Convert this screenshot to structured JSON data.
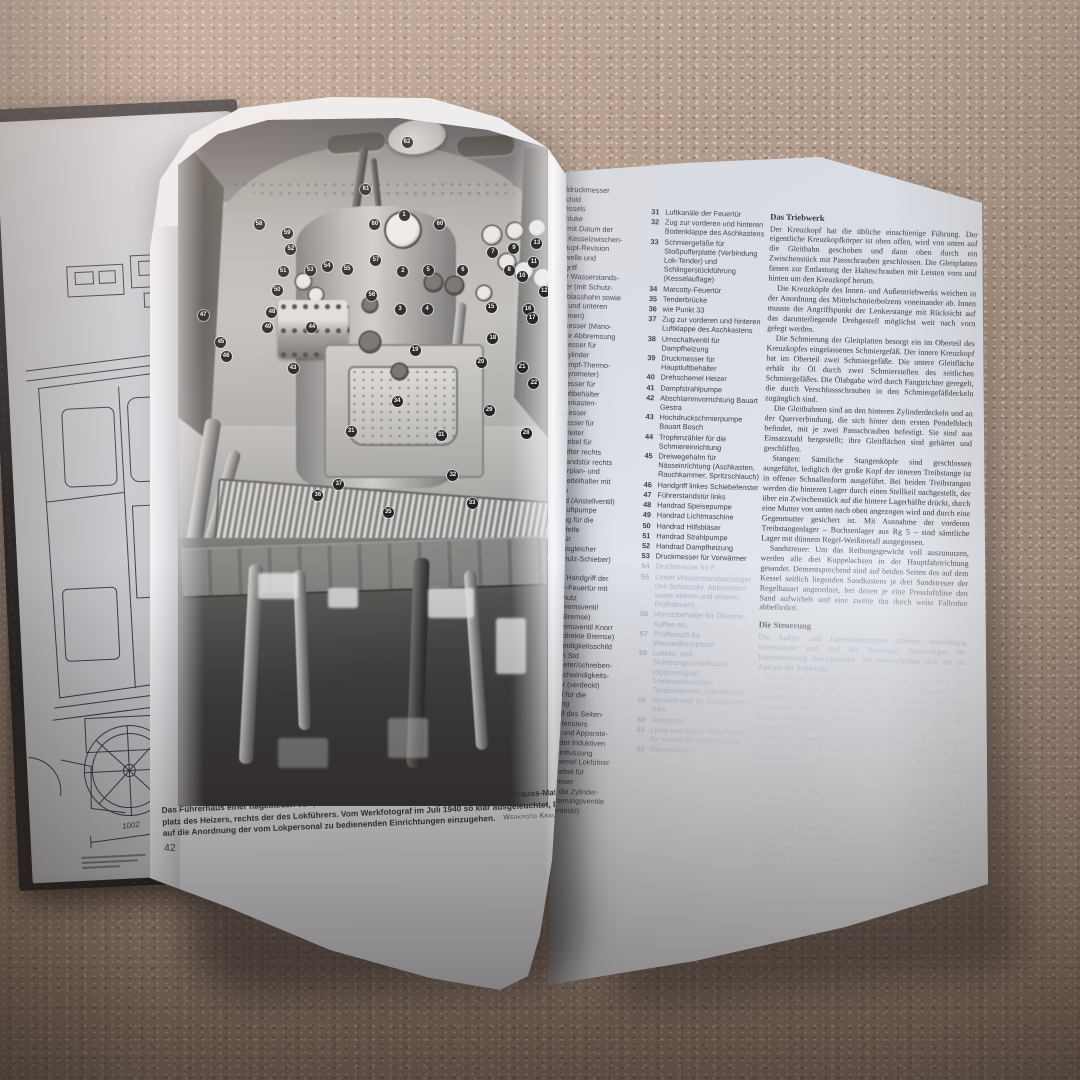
{
  "colors": {
    "carpet": "#ac9585",
    "paper": "#e3e6ec",
    "cover": "#1b1c20",
    "badge_bg": "#17171b",
    "badge_text": "#f4f4f2"
  },
  "drawing_page": {
    "dimension_label": "1002"
  },
  "photo_page": {
    "page_number": "42",
    "caption": {
      "line1": "Das Führerhaus einer nagelneuen 03¹⁰, hier der 03 1073, kurz vor ihrer Fertigstellung bei Krauss-Maffei in München. Links der",
      "line2": "platz des Heizers, rechts der des Lokführers. Vom Werkfotograf im Juli 1940 so klar ausgeleuchtet, lädt die Aufnahme",
      "line3": "auf die Anordnung der vom Lokpersonal zu bedienenden Einrichtungen einzugehen.",
      "credit": "Werkfoto Krauss-Maffei"
    },
    "badges": [
      {
        "n": "62",
        "x": 61.9,
        "y": 3.5
      },
      {
        "n": "61",
        "x": 50.8,
        "y": 10.4
      },
      {
        "n": "1",
        "x": 61.1,
        "y": 14.2
      },
      {
        "n": "60",
        "x": 53.2,
        "y": 15.5
      },
      {
        "n": "60",
        "x": 70.8,
        "y": 15.5
      },
      {
        "n": "58",
        "x": 21.9,
        "y": 15.5
      },
      {
        "n": "59",
        "x": 29.5,
        "y": 16.8
      },
      {
        "n": "52",
        "x": 30.5,
        "y": 19.1
      },
      {
        "n": "57",
        "x": 53.5,
        "y": 20.7
      },
      {
        "n": "2",
        "x": 60.8,
        "y": 22.3
      },
      {
        "n": "5",
        "x": 67.6,
        "y": 22.2
      },
      {
        "n": "6",
        "x": 77.0,
        "y": 22.2
      },
      {
        "n": "7",
        "x": 85.1,
        "y": 19.6
      },
      {
        "n": "9",
        "x": 90.8,
        "y": 19.0
      },
      {
        "n": "13",
        "x": 97.0,
        "y": 18.3
      },
      {
        "n": "11",
        "x": 96.2,
        "y": 21.0
      },
      {
        "n": "8",
        "x": 89.5,
        "y": 22.2
      },
      {
        "n": "10",
        "x": 93.0,
        "y": 23.0
      },
      {
        "n": "12",
        "x": 99.0,
        "y": 25.2
      },
      {
        "n": "51",
        "x": 28.4,
        "y": 22.3
      },
      {
        "n": "53",
        "x": 35.7,
        "y": 22.2
      },
      {
        "n": "54",
        "x": 40.3,
        "y": 21.6
      },
      {
        "n": "55",
        "x": 45.7,
        "y": 22.0
      },
      {
        "n": "50",
        "x": 26.8,
        "y": 25.1
      },
      {
        "n": "56",
        "x": 52.4,
        "y": 25.8
      },
      {
        "n": "3",
        "x": 60.0,
        "y": 27.8
      },
      {
        "n": "4",
        "x": 67.3,
        "y": 27.8
      },
      {
        "n": "48",
        "x": 25.4,
        "y": 28.3
      },
      {
        "n": "49",
        "x": 24.3,
        "y": 30.4
      },
      {
        "n": "44",
        "x": 36.2,
        "y": 30.4
      },
      {
        "n": "47",
        "x": 6.8,
        "y": 28.7
      },
      {
        "n": "45",
        "x": 11.6,
        "y": 32.6
      },
      {
        "n": "46",
        "x": 13.0,
        "y": 34.6
      },
      {
        "n": "15",
        "x": 84.6,
        "y": 27.5
      },
      {
        "n": "16",
        "x": 94.6,
        "y": 27.8
      },
      {
        "n": "17",
        "x": 95.7,
        "y": 29.1
      },
      {
        "n": "18",
        "x": 85.1,
        "y": 32.0
      },
      {
        "n": "19",
        "x": 64.1,
        "y": 33.8
      },
      {
        "n": "20",
        "x": 81.9,
        "y": 35.5
      },
      {
        "n": "21",
        "x": 93.0,
        "y": 36.2
      },
      {
        "n": "22",
        "x": 96.2,
        "y": 38.6
      },
      {
        "n": "43",
        "x": 31.1,
        "y": 36.4
      },
      {
        "n": "29",
        "x": 84.1,
        "y": 42.5
      },
      {
        "n": "28",
        "x": 94.1,
        "y": 45.9
      },
      {
        "n": "34",
        "x": 59.2,
        "y": 41.2
      },
      {
        "n": "31",
        "x": 46.8,
        "y": 45.5
      },
      {
        "n": "31",
        "x": 71.1,
        "y": 46.1
      },
      {
        "n": "32",
        "x": 74.3,
        "y": 51.9
      },
      {
        "n": "37",
        "x": 43.5,
        "y": 53.3
      },
      {
        "n": "36",
        "x": 37.8,
        "y": 54.9
      },
      {
        "n": "33",
        "x": 79.5,
        "y": 56.0
      },
      {
        "n": "35",
        "x": 56.8,
        "y": 57.4
      }
    ]
  },
  "right_page": {
    "page_number": "43",
    "legend_column1_fragments": [
      "sseldruckmesser",
      "rikschild",
      "s Kessels",
      "aschluke",
      "hild mit Datum der",
      "rten Kesselzwischen-",
      "d Haupt-Revision",
      "glerwelle und",
      "glergriff",
      "chter Wasserstands-",
      "zeiger (mit Schutz-",
      "rb, Ablasshahn sowie",
      "eren und unteren",
      "üfhähnen)",
      "uckmesser (Mano-",
      "ter) für Abbremsung",
      "uckmesser für",
      "emszylinder",
      "eißdampf-Thermo-",
      "ter (Pyrometer)",
      "uckmesser für",
      "auptluftbehälter",
      "chieberkasten-",
      "ruckmesser",
      "uckmesser für",
      "uptluftleiter",
      "rstellhebel für",
      "ckenlüfter rechts",
      "hrerstandstür rechts",
      "chtfahrplan- und",
      "remszettelhalter mit",
      "euchte",
      "andrad (Anstellventil)",
      "r die Luftpumpe",
      "ebelzug für die",
      "ampfpfeife",
      "child für",
      "ruckausgleicher",
      "arl-Schulz-Schieber)",
      "nlage",
      "echter Handgriff der",
      "arcotty-Feuertür mit",
      "andschutz",
      "usatzbremsventil",
      "irekte Bremse)",
      "hrerbremsventil Knorr",
      "r. 8 (indirekte Bremse)",
      "eschwindigkeitsschild",
      "150 km Std",
      "achometer/schreiben-",
      "er Geschwindigkeits-",
      "messer (verdeckt)",
      "andrad für die",
      "teuerung",
      "andgriff des Seiten-",
      "chiebefensters",
      "asten- und Apparate-",
      "asten der Induktiven",
      "ugbeeinflussung",
      "rehschemel Lokführer",
      "nstellhebel für",
      "andstreuer",
      "ug für die Zylinder-",
      "ntwässerungsventile",
      "alb verdeckt)"
    ],
    "legend": [
      {
        "n": "31",
        "text": "Luftkanäle der Feuertür"
      },
      {
        "n": "32",
        "text": "Zug zur vorderen und hinteren Bodenklappe des Aschkastens"
      },
      {
        "n": "33",
        "text": "Schmiergefäße für Stoßpufferplatte (Verbindung Lok-Tender) und Schlingerstückführung (Kesselauflage)"
      },
      {
        "n": "34",
        "text": "Marcotty-Feuertür"
      },
      {
        "n": "35",
        "text": "Tenderbrücke"
      },
      {
        "n": "36",
        "text": "wie Punkt 33"
      },
      {
        "n": "37",
        "text": "Zug zur vorderen und hinteren Luftklappe des Aschkastens"
      },
      {
        "n": "38",
        "text": "Umschaltventil für Dampfheizung"
      },
      {
        "n": "39",
        "text": "Druckmesser für Hauptluftbehälter"
      },
      {
        "n": "40",
        "text": "Drehschemel Heizer"
      },
      {
        "n": "41",
        "text": "Dampfstrahlpumpe"
      },
      {
        "n": "42",
        "text": "Abschlammvorrichtung Bauart Gestra"
      },
      {
        "n": "43",
        "text": "Hochdruckschmierpumpe Bauart Bosch"
      },
      {
        "n": "44",
        "text": "Tropfenzähler für die Schmiereinrichtung"
      },
      {
        "n": "45",
        "text": "Dreiwegehahn für Nässeinrichtung (Aschkasten, Rauchkammer, Spritzschlauch)"
      },
      {
        "n": "46",
        "text": "Handgriff linkes Schiebefenster"
      },
      {
        "n": "47",
        "text": "Führerstandstür links"
      },
      {
        "n": "48",
        "text": "Handrad Speisepumpe"
      },
      {
        "n": "49",
        "text": "Handrad Lichtmaschine"
      },
      {
        "n": "50",
        "text": "Handrad Hilfsbläser"
      },
      {
        "n": "51",
        "text": "Handrad Strahlpumpe"
      },
      {
        "n": "52",
        "text": "Handrad Dampfheizung"
      },
      {
        "n": "53",
        "text": "Druckmesser für Vorwärmer"
      },
      {
        "n": "54",
        "text": "Druckmesser für F…",
        "faint": true
      },
      {
        "n": "55",
        "text": "Linker Wasserstandsanzeiger (mit Schutzrohr, Ablasshahn sowie oberen und unteren Prüfhähnen)",
        "faint": true
      },
      {
        "n": "56",
        "text": "Vorratsbehälter für Ölkanne, Kaffee etc.",
        "faint": true
      },
      {
        "n": "57",
        "text": "Prüfflansch für Wasserdruckprobe",
        "faint": true
      },
      {
        "n": "58",
        "text": "Lokkist- und Sicherungsschaffkasten (Spitzensignal, Triebwerkleuchten, Tenderlaternen, Führerhaus)",
        "faint": true
      },
      {
        "n": "59",
        "text": "Verstellhebel für Deckenlüfter links",
        "faint": true
      },
      {
        "n": "60",
        "text": "Steckdose",
        "faint": true
      },
      {
        "n": "61",
        "text": "Linke und rechte Rüttelhebel für Kessel-Sicherheitsventil",
        "faint": true
      },
      {
        "n": "62",
        "text": "Deckenlampe",
        "faint": true
      }
    ],
    "sections": [
      {
        "heading": "Das Triebwerk",
        "paragraphs": [
          {
            "fade": 0,
            "text": "Der Kreuzkopf hat die übliche einschienige Führung. Der eigentliche Kreuzkopfkörper ist oben offen, wird von unten auf die Gleitbahn geschoben und dann oben durch ein Zwischenstück mit Passschrauben geschlossen. Die Gleitplatten fassen zur Entlastung der Halteschrauben mit Leisten vorn und hinten um den Kreuzkopf herum."
          },
          {
            "fade": 0,
            "text": "Die Kreuzköpfe des Innen- und Außentriebwerks weichen in der Anordnung des Mittelschmierbolzens voneinander ab. Innen musste der Angriffspunkt der Lenkerstange mit Rücksicht auf das darunterliegende Drehgestell möglichst weit nach vorn gelegt werden."
          },
          {
            "fade": 0,
            "text": "Die Schmierung der Gleitplatten besorgt ein im Oberteil des Kreuzkopfes eingelassenes Schmiergefäß. Der innere Kreuzkopf hat im Oberteil zwei Schmiergefäße. Die untere Gleitfläche erhält ihr Öl durch zwei Schmierstellen des seitlichen Schmiergefäßes. Die Ölabgabe wird durch Fangtrichter geregelt, die durch Verschlussschrauben in den Schmiergefäßdeckeln zugänglich sind."
          },
          {
            "fade": 0,
            "text": "Die Gleitbahnen sind an den hinteren Zylinderdeckeln und an der Querverbindung, die sich hinter dem ersten Pendelblech befindet, mit je zwei Passschrauben befestigt. Sie sind aus Einsatzstahl hergestellt; ihre Gleitflächen sind gehärtet und geschliffen."
          },
          {
            "fade": 0,
            "text": "Stangen: Sämtliche Stangenköpfe sind geschlossen ausgeführt, lediglich der große Kopf der inneren Treibstange ist in offener Schnallenform ausgeführt. Bei beiden Treibstangen werden die hinteren Lager durch einen Stellkeil nachgestellt, der über ein Zwischenstück auf die hintere Lagerhälfte drückt, durch eine Mutter von unten nach oben angezogen wird und durch eine Gegenmutter gesichert ist. Mit Ausnahme der vorderen Treibstangenlager – Buchsenlager aus Rg 5 – sind sämtliche Lager mit dünnem Regel-Weißmetall ausgegossen."
          },
          {
            "fade": 0,
            "text": "Sandstreuer: Um das Reibungsgewicht voll auszunutzen, werden alle drei Kuppelachsen in der Hauptfahrtrichtung gesandet. Dementsprechend sind auf beiden Seiten des auf dem Kessel seitlich liegenden Sandkastens je drei Sandstreuer der Regelbauart angeordnet, bei denen je eine Pressluftdüse den Sand aufwirbelt und eine zweite ihn durch weite Fallrohre abbefördert."
          }
        ]
      },
      {
        "heading": "Die Steuerung",
        "paragraphs": [
          {
            "fade": 1,
            "text": "Die Außen- und Innensteuerungen arbeiten unabhängig voneinander und sind als Heusinger Steuerungen für Innensteuerung durchgebildet. Sie unterscheiden sich nur am Antrieb der Schwinge."
          },
          {
            "fade": 2,
            "text": "Die äußere Schwinge wird in bekannter Weise über die Gegenkurbel und die Schwingenstange im unteren Teil angetrieben, wobei die Schwingenlager zu entlasten sind. Der Voreilhebel oberhalb der Achse in der Anlenkung zeigt die übliche Ausführung, während die innere Schwinge durch die gekröpfte Achswelle des Mittelradsatzes angetrieben wird."
          },
          {
            "fade": 2,
            "text": "Bei der Übertragung der Kurbelbewegung auf die innere Schwinge musste Rücksicht auf den als Treibachse für das Innentriebwerk durchgekröpften ersten Kuppelradsatz genommen werden. Die innere Schwinge ist daher hinter dem ersten Kuppelradsatz angeordnet worden."
          },
          {
            "fade": 2,
            "text": "Die Außen- wie Innensteuerung ergibt Füllungen bis zu 90 für Vorwärts- und 74 % für Rückwärtsfahrt. Die Steuerung ist sinnfällig bedient: Bei Vorwärtsfahrt läuft also die Steuerung nach vorn und zeigt den Füllungsgrad auf einer mit roten Ziffern versehenen Füllungsskala an. Der Steuerbock ist am Stehkessel befestigt. Die Steuerstange besteht aus einem nahtlosen Rohr 70 × 3 mm, in das die Gabeln eingeschweißt sind. Sie wird mit einer etwa in der Mitte angebrachten Beigeschwinge am Kessel geführt."
          }
        ]
      }
    ]
  }
}
